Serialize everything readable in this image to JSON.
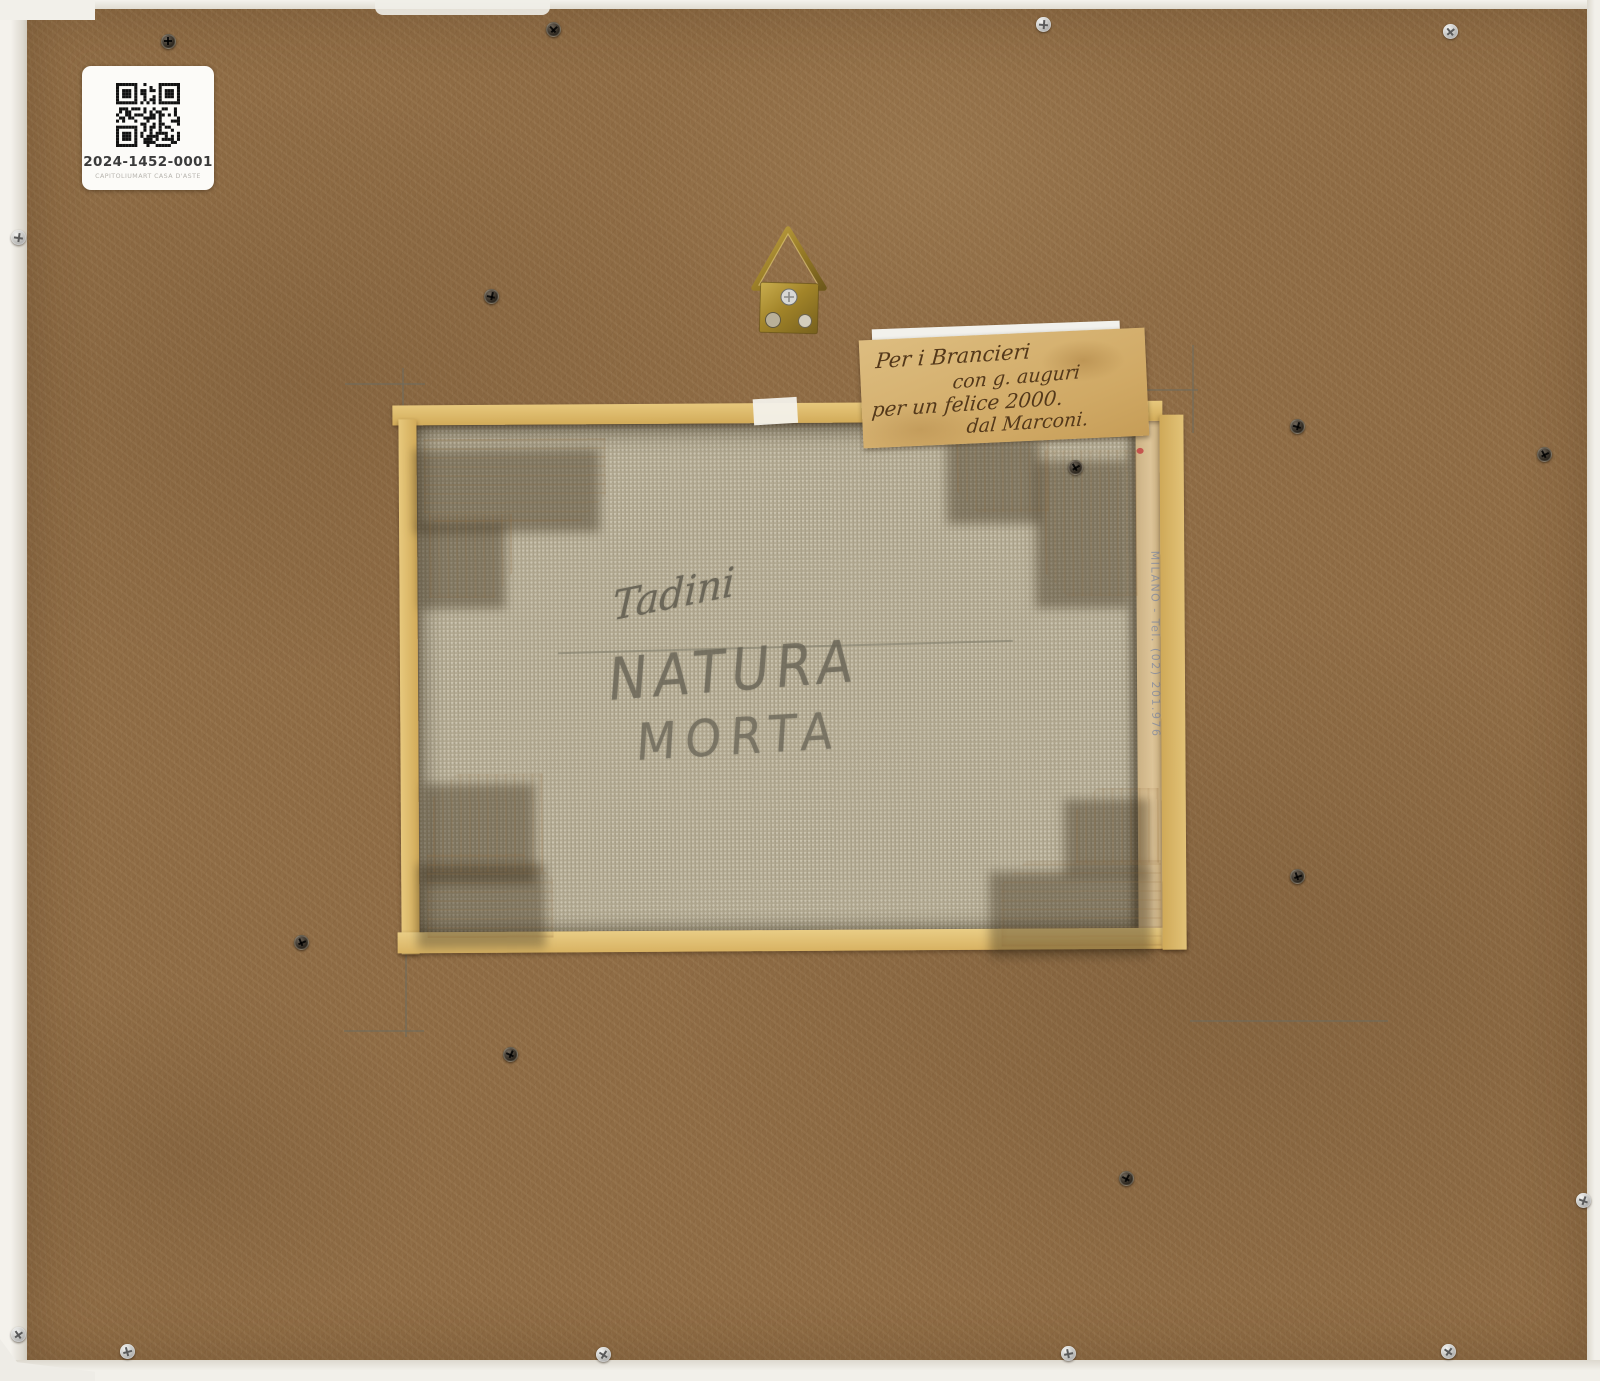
{
  "artwork_back": {
    "auction_label": {
      "qr_icon": "qr-code",
      "lot_code": "2024-1452-0001",
      "auction_house": "CAPITOLIUMART CASA D'ASTE"
    },
    "dedication_note": {
      "lines": [
        "Per i Brancieri",
        "con g. auguri",
        "per un felice 2000.",
        "dal Marconi."
      ]
    },
    "canvas_inscription": {
      "signature": "Tadini",
      "title_lines": [
        "NATURA",
        "MORTA"
      ]
    },
    "stretcher_stamp": {
      "text": "MILANO - Tel. (02) 201.976"
    },
    "hardware": {
      "hanger": "brass-triangle-hanger",
      "screws": [
        {
          "x": 167,
          "y": 40,
          "variant": "dark"
        },
        {
          "x": 552,
          "y": 28,
          "variant": "dark"
        },
        {
          "x": 1043,
          "y": 24,
          "variant": "silver"
        },
        {
          "x": 1450,
          "y": 31,
          "variant": "silver"
        },
        {
          "x": 18,
          "y": 237,
          "variant": "silver"
        },
        {
          "x": 18,
          "y": 1334,
          "variant": "silver"
        },
        {
          "x": 490,
          "y": 295,
          "variant": "dark"
        },
        {
          "x": 1074,
          "y": 466,
          "variant": "dark"
        },
        {
          "x": 1296,
          "y": 425,
          "variant": "dark"
        },
        {
          "x": 1543,
          "y": 453,
          "variant": "dark"
        },
        {
          "x": 1583,
          "y": 1200,
          "variant": "silver"
        },
        {
          "x": 300,
          "y": 941,
          "variant": "dark"
        },
        {
          "x": 509,
          "y": 1053,
          "variant": "dark"
        },
        {
          "x": 1296,
          "y": 875,
          "variant": "dark"
        },
        {
          "x": 1125,
          "y": 1177,
          "variant": "dark"
        },
        {
          "x": 127,
          "y": 1351,
          "variant": "silver"
        },
        {
          "x": 603,
          "y": 1354,
          "variant": "silver"
        },
        {
          "x": 1068,
          "y": 1353,
          "variant": "silver"
        },
        {
          "x": 1448,
          "y": 1351,
          "variant": "silver"
        }
      ]
    },
    "colors": {
      "board": "#8e6b44",
      "frame_edge": "#ebe8e2",
      "canvas": "#b1a890",
      "lath": "#dcb96b",
      "corner_block": "#e0c9a4",
      "brass": "#a98a2f",
      "ink": "#53381a",
      "pencil": "#75725f"
    }
  }
}
